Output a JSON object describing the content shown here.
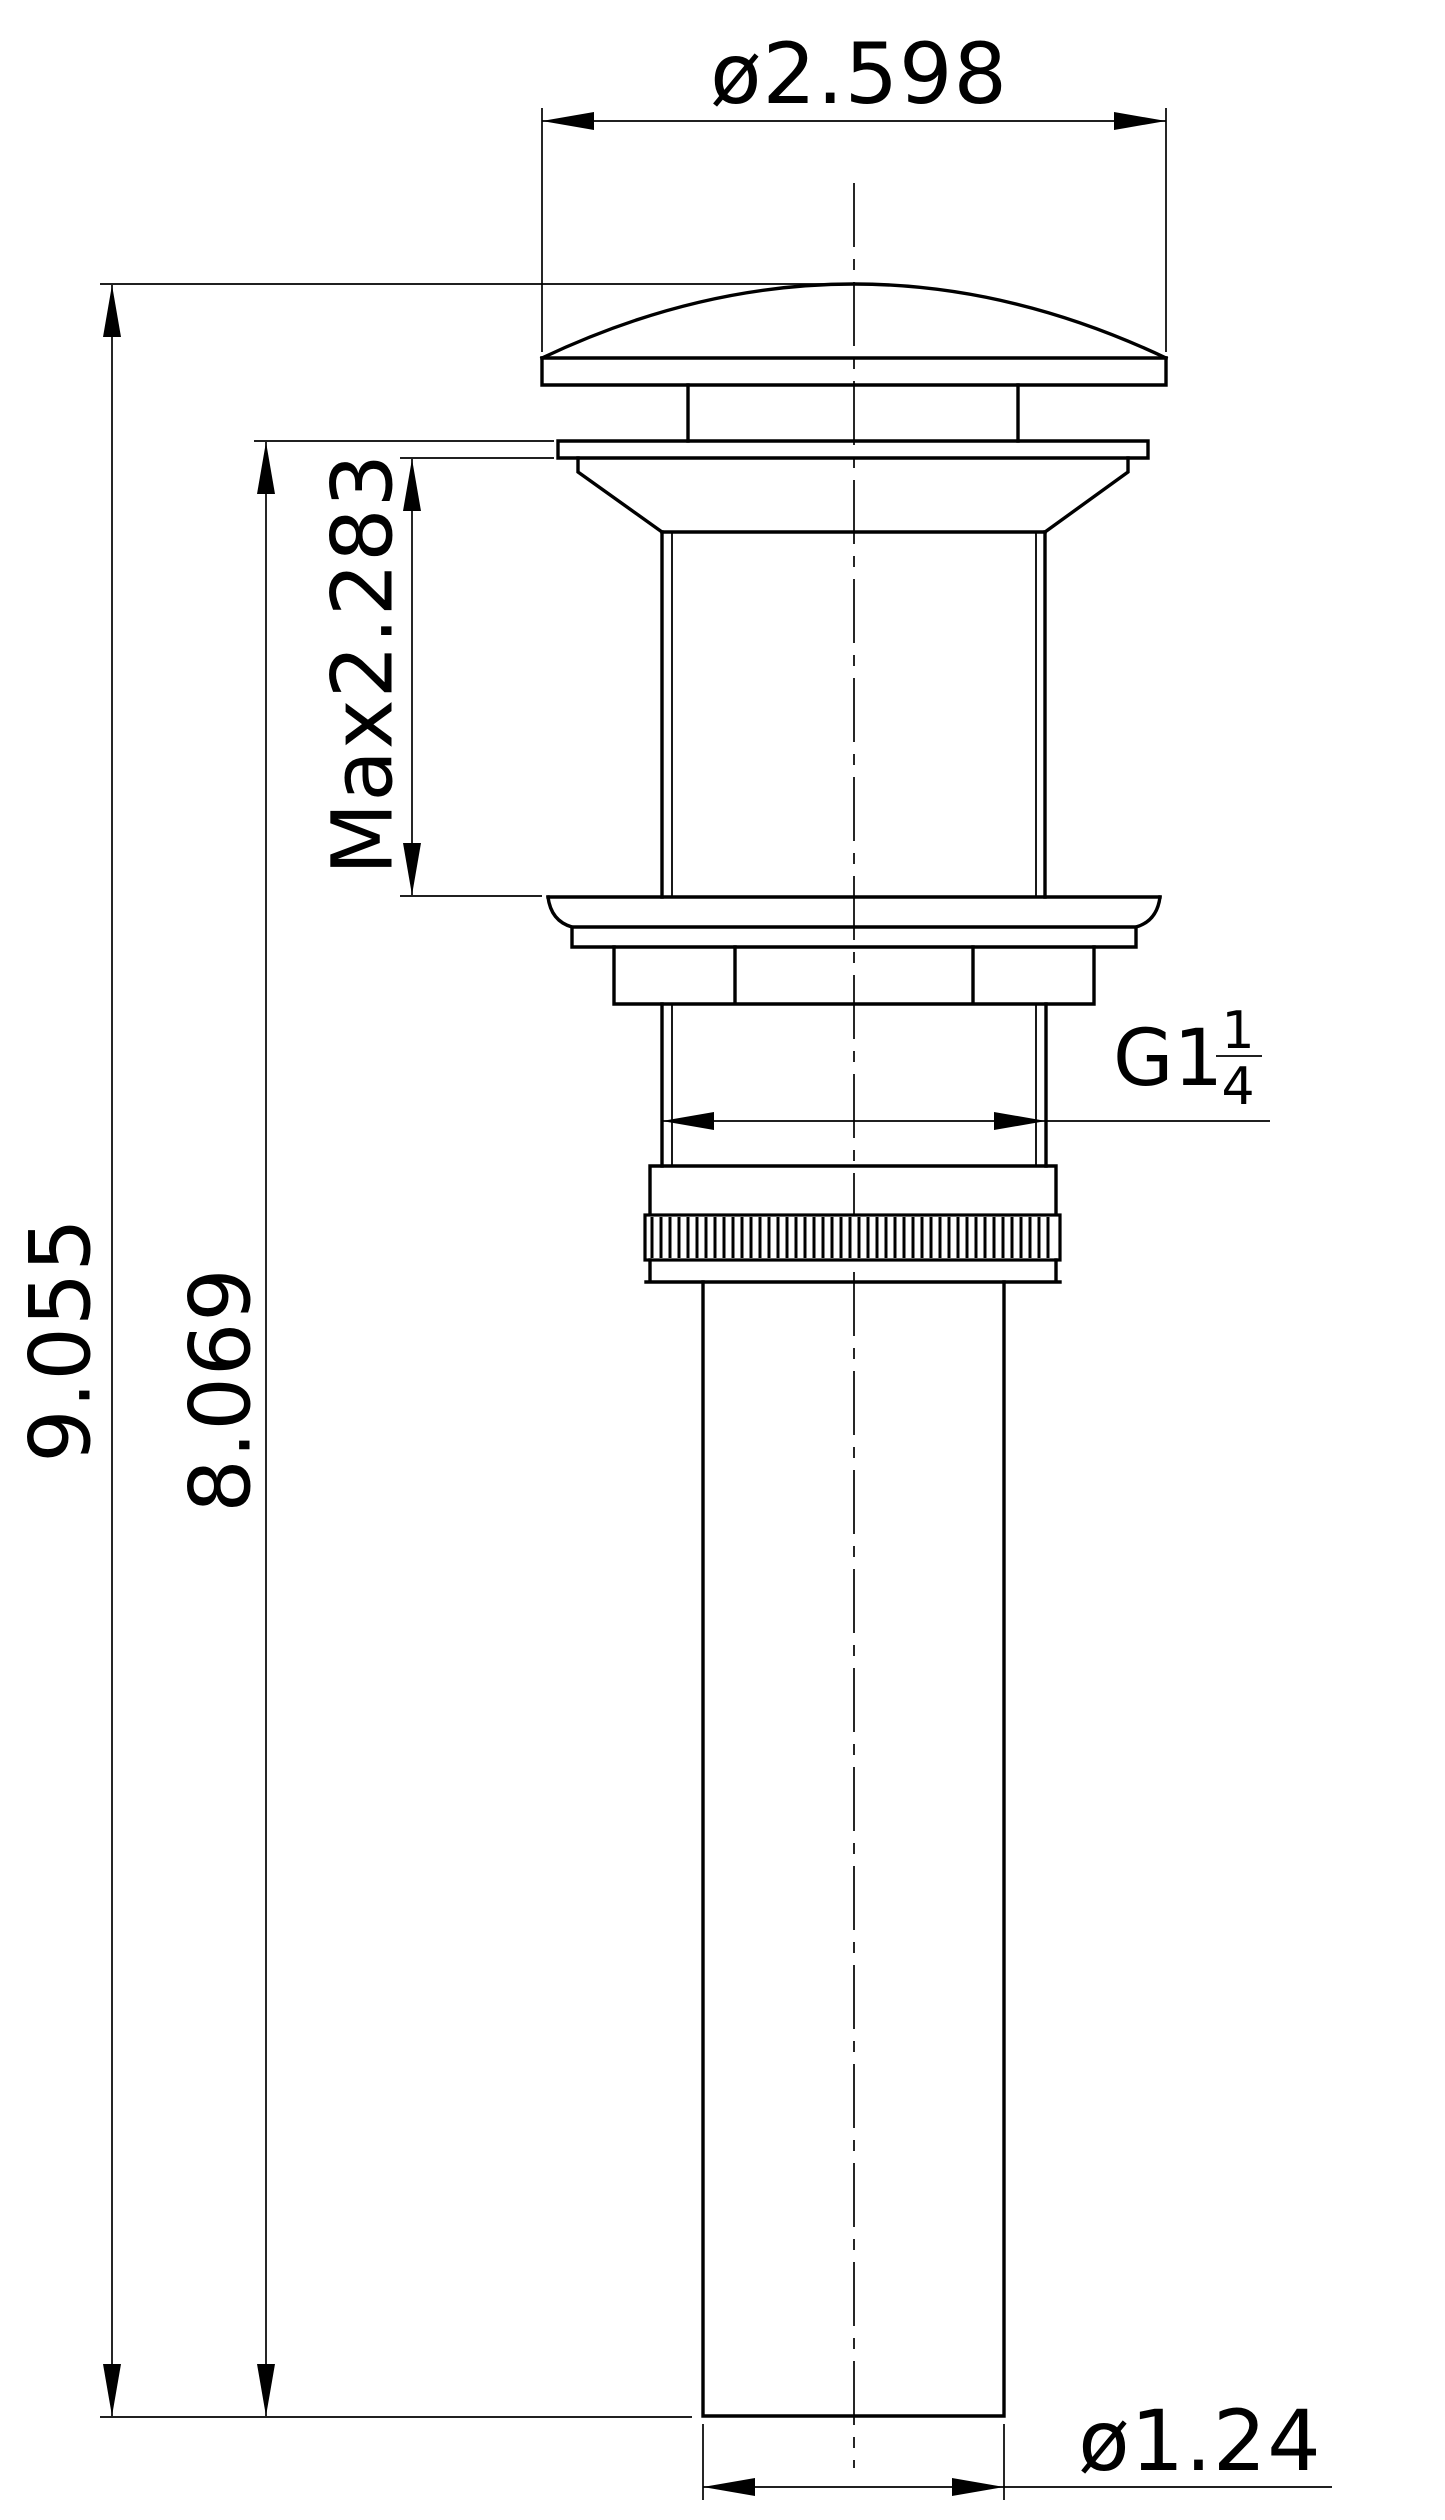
{
  "drawing": {
    "background": "#ffffff",
    "line_color": "#000000",
    "labels": {
      "cap_diameter": "ø2.598",
      "max_insert_depth": "Max2.283",
      "overall_height": "9.055",
      "below_flange_height": "8.069",
      "thread_size_prefix": "G1",
      "thread_fraction_numerator": "1",
      "thread_fraction_denominator": "4",
      "tail_pipe_diameter": "ø1.24"
    }
  }
}
